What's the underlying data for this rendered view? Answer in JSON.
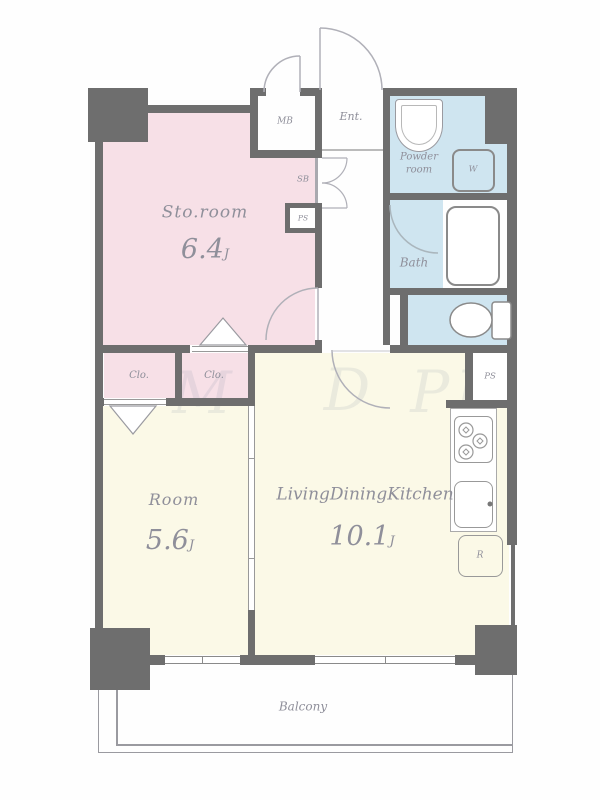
{
  "plan": {
    "rooms": {
      "sto": {
        "name": "Sto.room",
        "area": "6.4",
        "unit": "J"
      },
      "bedroom": {
        "name": "Room",
        "area": "5.6",
        "unit": "J"
      },
      "ldk": {
        "name": "LivingDiningKitchen",
        "area": "10.1",
        "unit": "J"
      },
      "bath": {
        "name": "Bath"
      },
      "powder": {
        "line1": "Powder",
        "line2": "room"
      },
      "entrance": {
        "name": "Ent."
      },
      "balcony": {
        "name": "Balcony"
      }
    },
    "labels": {
      "mb": "MB",
      "sb": "SB",
      "ps": "PS",
      "w": "W",
      "r": "R",
      "clo": "Clo."
    },
    "colors": {
      "wall": "#6e6e6e",
      "storage_pink": "#f7e0e7",
      "living_cream": "#fbf9e7",
      "wet_blue": "#cfe5f0",
      "text": "#8f8f9a",
      "line": "#b0b0b8"
    },
    "watermark": {
      "fragments": [
        "M",
        "D",
        "PL"
      ]
    }
  }
}
